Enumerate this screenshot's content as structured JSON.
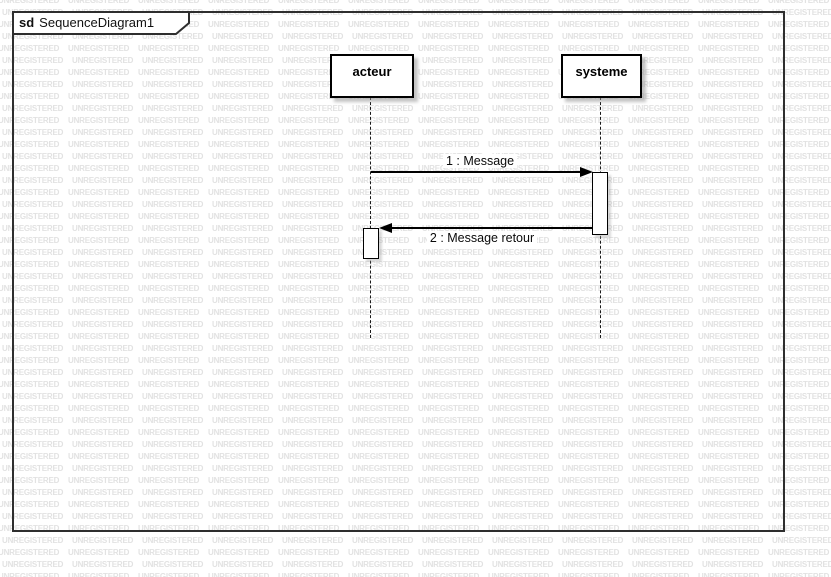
{
  "watermark": {
    "text": "UNREGISTERED",
    "color": "#e2e2e2"
  },
  "frame": {
    "keyword": "sd",
    "title": "SequenceDiagram1"
  },
  "lifelines": [
    {
      "name": "acteur"
    },
    {
      "name": "systeme"
    }
  ],
  "messages": [
    {
      "label": "1 : Message",
      "direction": "right"
    },
    {
      "label": "2 : Message retour",
      "direction": "left"
    }
  ],
  "colors": {
    "background": "#ffffff",
    "frame_border": "#2e2e2e",
    "shape_border": "#000000",
    "shadow": "#c8c8c8",
    "watermark": "#e2e2e2"
  }
}
